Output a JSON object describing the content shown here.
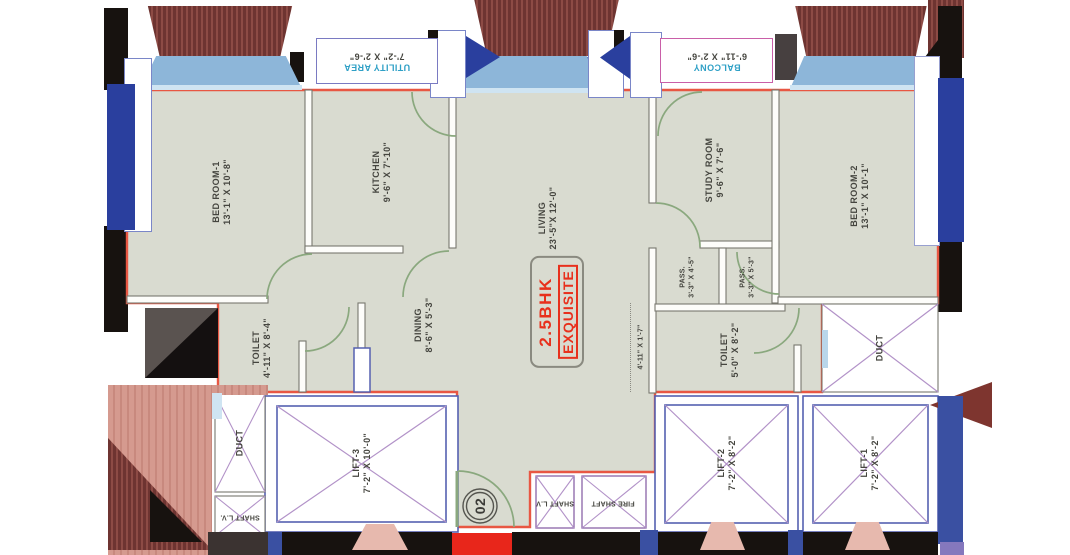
{
  "brand": {
    "line1": "2.5BHK",
    "line2": "EXQUISITE"
  },
  "unit_number": "02",
  "rooms": {
    "bedroom1": {
      "name": "BED ROOM-1",
      "dims": "13'-1\" X 10'-8\""
    },
    "kitchen": {
      "name": "KITCHEN",
      "dims": "9'-6\" X 7'-10\""
    },
    "living": {
      "name": "LIVING",
      "dims": "23'-5\"X 12'-0\""
    },
    "study": {
      "name": "STUDY ROOM",
      "dims": "9'-6\" X 7'-6\""
    },
    "bedroom2": {
      "name": "BED ROOM-2",
      "dims": "13'-1\" X 10'-1\""
    },
    "toilet1": {
      "name": "TOILET",
      "dims": "4'-11\" X 8'-4\""
    },
    "dining": {
      "name": "DINING",
      "dims": "8'-6\" X 5'-3\""
    },
    "toilet2": {
      "name": "TOILET",
      "dims": "5'-0\" X 8'-2\""
    },
    "pass1": {
      "name": "PASS.",
      "dims": "3'-3\" X 4'-5\""
    },
    "pass2": {
      "name": "PASS.",
      "dims": "3'-3\" X 5'-3\""
    },
    "foyer": {
      "dims": "4'-11\" X 1'-7\""
    },
    "utility": {
      "name": "UTILITY AREA",
      "dims": "7'-2\" X 2'-6\""
    },
    "balcony": {
      "name": "BALCONY",
      "dims": "6'-11\" X 2'-6\""
    },
    "duct_left": {
      "name": "DUCT"
    },
    "duct_right": {
      "name": "DUCT"
    },
    "lift3": {
      "name": "LIFT-3",
      "dims": "7'-2\" X 10'-0\""
    },
    "lift2": {
      "name": "LIFT-2",
      "dims": "7'-2\" X 8'-2\""
    },
    "lift1": {
      "name": "LIFT-1",
      "dims": "7'-2\" X 8'-2\""
    },
    "shaft_lv_left": {
      "name": "SHAFT L.V."
    },
    "shaft_lv_mid": {
      "name": "SHAFT L.V"
    },
    "fire_shaft": {
      "name": "FIRE SHAFT"
    }
  },
  "palette": {
    "unit_boundary": "#e85743",
    "brand_red": "#e8301c",
    "balcony_label_cyan": "#2fa0c6",
    "door_green": "#8aa87e",
    "lift_wall_blue": "#5560b0",
    "cross_purple": "#b292c8",
    "window_blue": "#8db6d9",
    "navy_window": "#2a3f9e",
    "brick_hatch": "#6e3431",
    "neighbour_salmon": "#d59a8f",
    "floor": "#d9dbd0"
  }
}
